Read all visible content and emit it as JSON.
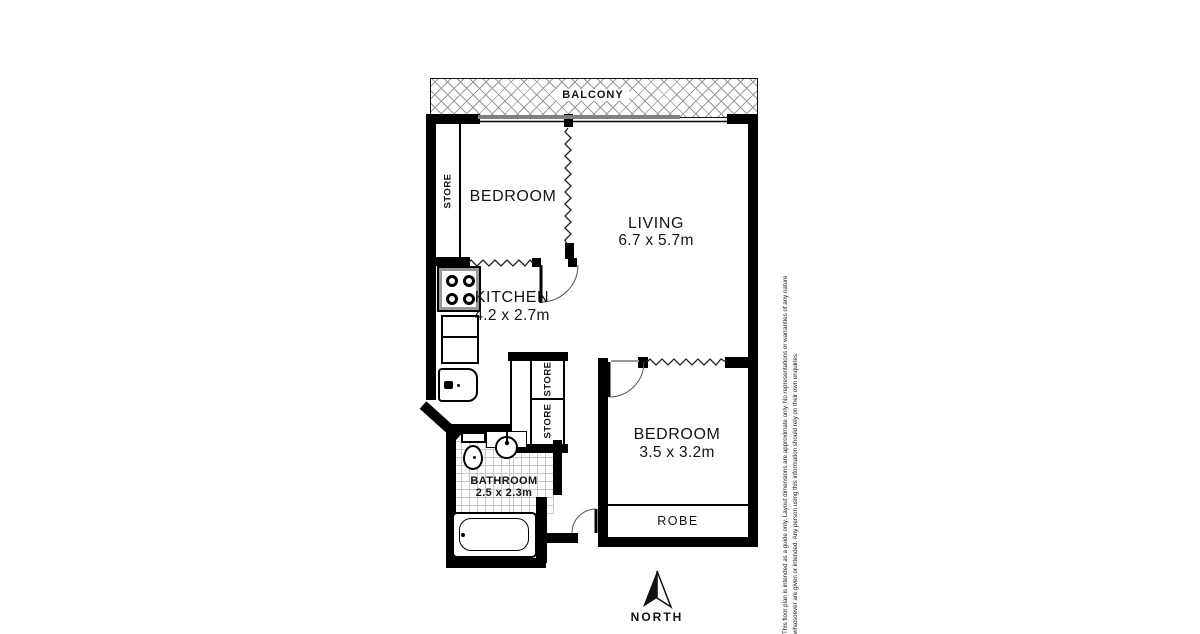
{
  "plan": {
    "balcony": "BALCONY",
    "store_top_left": "STORE",
    "bedroom1": "BEDROOM",
    "living": "LIVING",
    "living_dims": "6.7 x 5.7m",
    "kitchen": "KITCHEN",
    "kitchen_dims": "4.2 x 2.7m",
    "store_mid_upper": "STORE",
    "store_mid_lower": "STORE",
    "bathroom": "BATHROOM",
    "bathroom_dims": "2.5 x 2.3m",
    "bedroom2": "BEDROOM",
    "bedroom2_dims": "3.5 x 3.2m",
    "robe": "ROBE"
  },
  "compass": {
    "north": "NORTH"
  },
  "disclaimer": {
    "line1": "This floor plan is intended as a guide only. Layout dimensions are approximate only. No representations or warranties of any nature",
    "line2": "whatsoever are given or intended. Any person using this information should rely on their own enquiries"
  },
  "colors": {
    "wall": "#000000",
    "hatch": "#9a9a9a",
    "tile_line": "#c7c7c7"
  }
}
